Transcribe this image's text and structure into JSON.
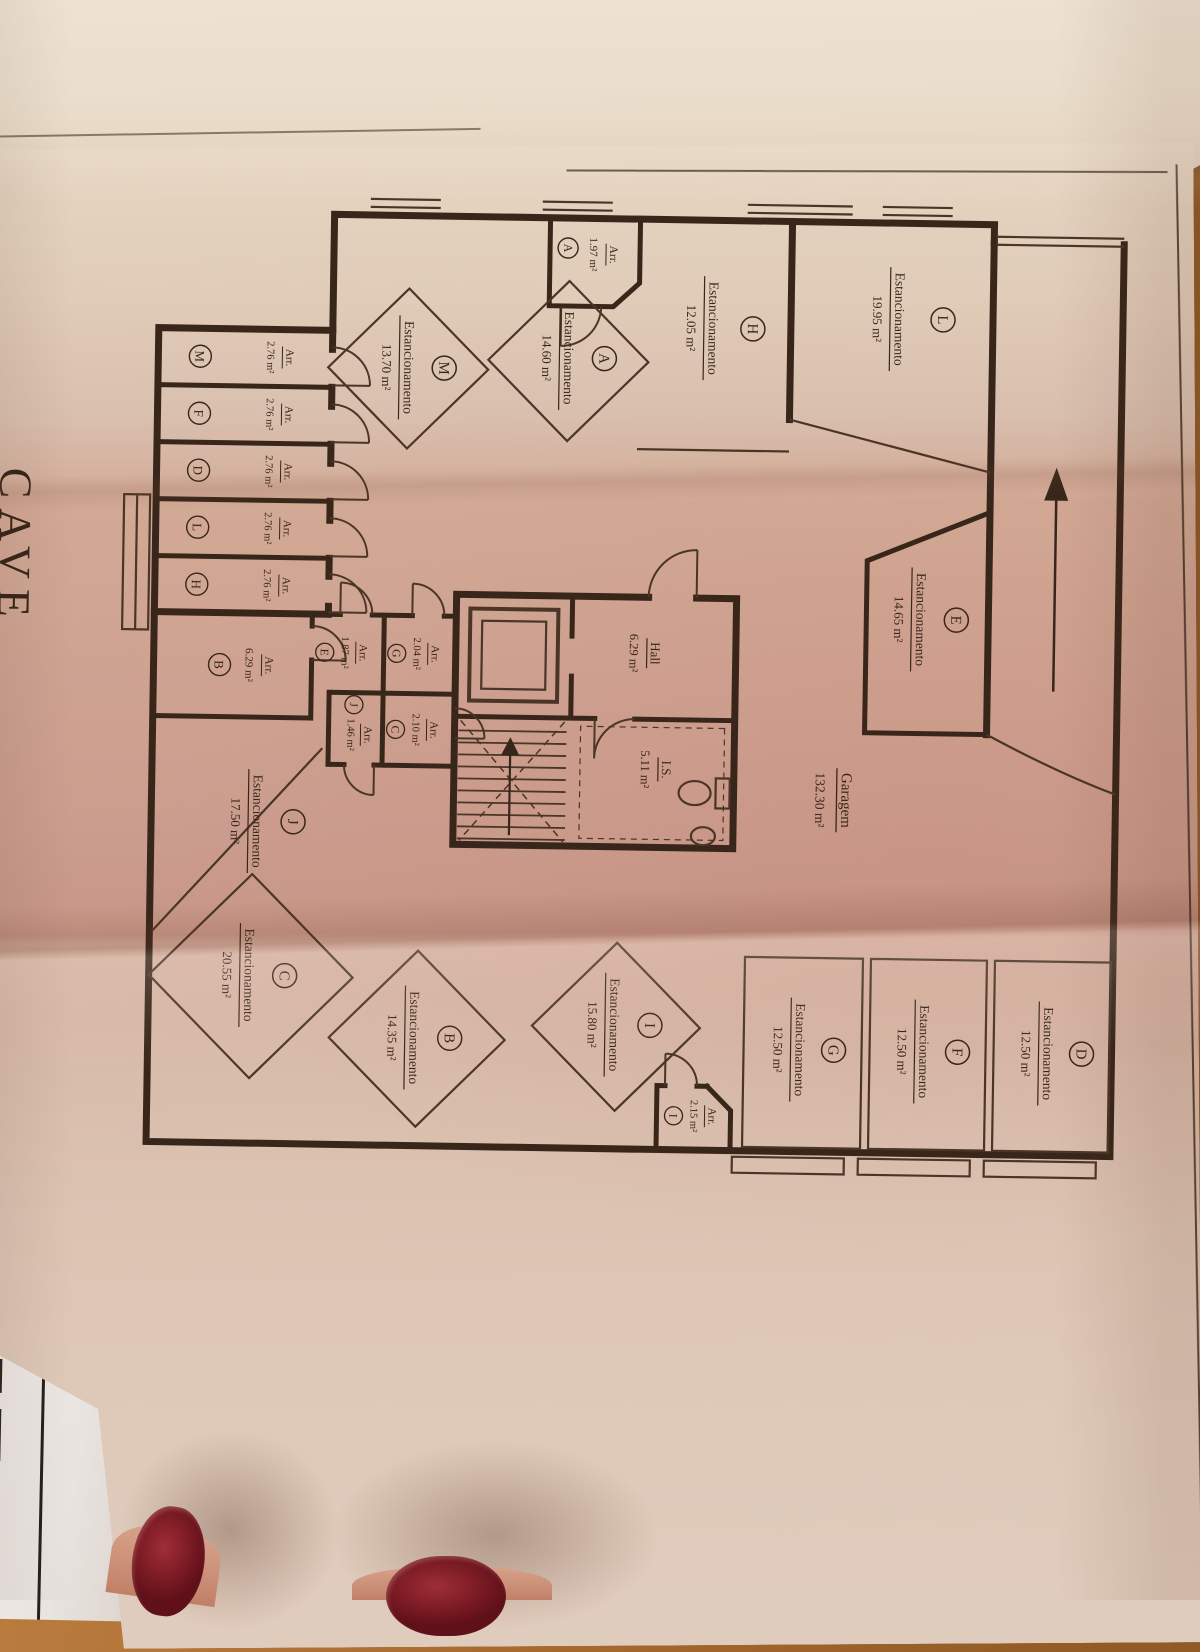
{
  "photo": {
    "floor_title": "CAVE",
    "edge_label": "-2"
  },
  "plan": {
    "labels": {
      "parking": "Estancionamento",
      "storage": "Arr."
    },
    "garage": {
      "name": "Garagem",
      "area": "132.30 m²"
    },
    "hall": {
      "name": "Hall",
      "area": "6.29 m²"
    },
    "wc": {
      "name": "I.S.",
      "area": "5.11 m²"
    },
    "parking": [
      {
        "letter": "L",
        "area": "19.95 m²"
      },
      {
        "letter": "H",
        "area": "12.05 m²"
      },
      {
        "letter": "A",
        "area": "14.60 m²"
      },
      {
        "letter": "M",
        "area": "13.70 m²"
      },
      {
        "letter": "E",
        "area": "14.65 m²"
      },
      {
        "letter": "J",
        "area": "17.50 m²"
      },
      {
        "letter": "I",
        "area": "15.80 m²"
      },
      {
        "letter": "B",
        "area": "14.35 m²"
      },
      {
        "letter": "C",
        "area": "20.55 m²"
      },
      {
        "letter": "G",
        "area": "12.50 m²"
      },
      {
        "letter": "F",
        "area": "12.50 m²"
      },
      {
        "letter": "D",
        "area": "12.50 m²"
      }
    ],
    "storage": [
      {
        "letter": "A",
        "area": "1.97 m²"
      },
      {
        "letter": "M",
        "area": "2.76 m²"
      },
      {
        "letter": "F",
        "area": "2.76 m²"
      },
      {
        "letter": "D",
        "area": "2.76 m²"
      },
      {
        "letter": "L",
        "area": "2.76 m²"
      },
      {
        "letter": "H",
        "area": "2.76 m²"
      },
      {
        "letter": "B",
        "area": "6.29 m²"
      },
      {
        "letter": "E",
        "area": "1.87 m²"
      },
      {
        "letter": "G",
        "area": "2.04 m²"
      },
      {
        "letter": "J",
        "area": "1.46 m²"
      },
      {
        "letter": "C",
        "area": "2.10 m²"
      },
      {
        "letter": "I",
        "area": "2.15 m²"
      }
    ]
  }
}
